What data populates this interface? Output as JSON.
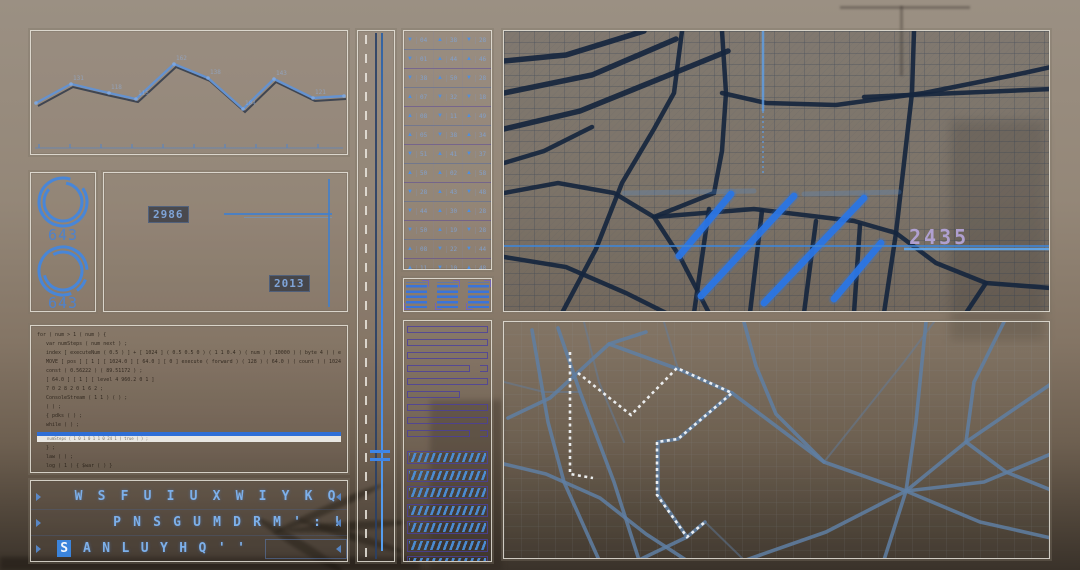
{
  "colors": {
    "accent": "#3b84dc",
    "chart_line": "#6592cf",
    "ring": "#4886d8",
    "indigo": "#4a3f9f",
    "navy": "#16263e",
    "slate": "#5f7fa3",
    "lavender": "#b3a3d6",
    "route_white": "#f2f5f8"
  },
  "line_chart": {
    "points": [
      [
        5,
        72
      ],
      [
        40,
        53
      ],
      [
        78,
        62
      ],
      [
        105,
        68
      ],
      [
        143,
        33
      ],
      [
        177,
        47
      ],
      [
        212,
        78
      ],
      [
        243,
        48
      ],
      [
        282,
        67
      ],
      [
        313,
        65
      ]
    ],
    "labels": [
      "",
      "131",
      "118",
      "115",
      "162",
      "138",
      "104",
      "143",
      "121",
      ""
    ],
    "axis_y": 117,
    "tick_count": 11,
    "tick_start": 8,
    "tick_step": 31
  },
  "gauges": [
    {
      "value": "643"
    },
    {
      "value": "643"
    }
  ],
  "detail": {
    "metric_a": "2986",
    "metric_b": "2013"
  },
  "code_panel": {
    "lines": [
      "for ( num > 1 ( num ) {",
      "var numSteps ( num next ) ;",
      "index [ executeNum ( 0.5 ) ] + [ 1024 ] ( 0.5 0.5 0 ) ( 1 1 0.4 ) ( num ) ( 10000 ) ( byte 4 ) ( executeFlow.up limits.MoveBytes ) ( 1 ) ( 0 ) ( num )",
      "MOVE [ pos ] [ 1 ] [ 1024.0 ] [ 64.0 ] [ 0 ] execute ( forward ) ( 128 ) ( 64.0 ) ( count ) ( 1024 50.0 1 ) ( random ( 100 ) ) ( 1 ) ( 0 )",
      "const ( 0.56222 ) ( 89.51172 ) ;",
      "[ 64.0 ] [ 1 ] [ level 4 960.2 0 1 ]",
      "7 0 2 8 2 0 1 6 2 ;",
      "ConsoleStream ( 1 1 ) ( ) ;",
      "( ) ;",
      "{ pdks ( ) ;",
      "while ( ) ;"
    ],
    "highlight": "numSteps ( 1 0 1 0 1 1 0 24 1 ) true ( ) ;",
    "post_lines": [
      "} ;",
      "law ( ) ;",
      "log ( 1 ) { $war ( ) }",
      "// ( framed ) abject task"
    ]
  },
  "keyboard": {
    "rows": [
      [
        "W",
        "S",
        "F",
        "U",
        "I",
        "U",
        "X",
        "W",
        "I",
        "Y",
        "K",
        "Q"
      ],
      [
        "P",
        "N",
        "S",
        "G",
        "U",
        "M",
        "D",
        "R",
        "M",
        "'",
        ":",
        "!"
      ],
      [
        "S",
        "A",
        "N",
        "L",
        "U",
        "Y",
        "H",
        "Q",
        "'",
        "'"
      ]
    ],
    "active": {
      "row": 2,
      "index": 0
    }
  },
  "icon_grid": {
    "rows": [
      [
        {
          "d": "dn",
          "n": "04"
        },
        {
          "d": "up",
          "n": "38"
        },
        {
          "d": "dn",
          "n": "28"
        }
      ],
      [
        {
          "d": "dn",
          "n": "01"
        },
        {
          "d": "up",
          "n": "44"
        },
        {
          "d": "up",
          "n": "46"
        }
      ],
      [
        {
          "d": "dn",
          "n": "38"
        },
        {
          "d": "up",
          "n": "50"
        },
        {
          "d": "dn",
          "n": "28"
        }
      ],
      [
        {
          "d": "up",
          "n": "07"
        },
        {
          "d": "dn",
          "n": "32"
        },
        {
          "d": "dn",
          "n": "18"
        }
      ],
      [
        {
          "d": "up",
          "n": "08"
        },
        {
          "d": "dn",
          "n": "11"
        },
        {
          "d": "up",
          "n": "49"
        }
      ],
      [
        {
          "d": "up",
          "n": "05"
        },
        {
          "d": "dn",
          "n": "38"
        },
        {
          "d": "up",
          "n": "34"
        }
      ],
      [
        {
          "d": "dn",
          "n": "51"
        },
        {
          "d": "up",
          "n": "41"
        },
        {
          "d": "dn",
          "n": "37"
        }
      ],
      [
        {
          "d": "up",
          "n": "50"
        },
        {
          "d": "up",
          "n": "02"
        },
        {
          "d": "up",
          "n": "58"
        }
      ],
      [
        {
          "d": "dn",
          "n": "28"
        },
        {
          "d": "up",
          "n": "43"
        },
        {
          "d": "dn",
          "n": "48"
        }
      ],
      [
        {
          "d": "dn",
          "n": "44"
        },
        {
          "d": "up",
          "n": "30"
        },
        {
          "d": "up",
          "n": "28"
        }
      ],
      [
        {
          "d": "dn",
          "n": "50"
        },
        {
          "d": "up",
          "n": "19"
        },
        {
          "d": "dn",
          "n": "28"
        }
      ],
      [
        {
          "d": "up",
          "n": "08"
        },
        {
          "d": "dn",
          "n": "22"
        },
        {
          "d": "dn",
          "n": "44"
        }
      ],
      [
        {
          "d": "up",
          "n": "11"
        },
        {
          "d": "dn",
          "n": "10"
        },
        {
          "d": "up",
          "n": "48"
        }
      ]
    ]
  },
  "mini_blocks": {
    "count": 3
  },
  "bars": {
    "outline": [
      {
        "w": 100
      },
      {
        "w": 100
      },
      {
        "w": 100
      },
      {
        "w": 78,
        "br": true
      },
      {
        "w": 100
      },
      {
        "w": 66
      },
      {
        "w": 100
      },
      {
        "w": 100
      },
      {
        "w": 78,
        "br": true
      }
    ],
    "hatched": 8
  },
  "map_top": {
    "label": "2435",
    "major_roads": [
      "M0,62 L88,44 L172,8",
      "M0,98 L76,80 L170,42 L224,20",
      "M0,30 L62,24 L140,0",
      "M58,282 L92,218 L118,152 L150,98 L170,62 L178,0",
      "M0,162 L54,152 L110,162 L150,186 L210,162 L218,120 L222,62 L218,0",
      "M218,62 L262,72 L332,74 L420,62 L520,42 L547,36",
      "M150,186 L176,226 L205,282",
      "M150,186 L250,178 L350,190 L392,202",
      "M410,0 L408,62 L400,132 L392,202 L380,282",
      "M392,202 L432,232 L482,252 L547,257",
      "M360,66 L547,58",
      "M0,226 L62,236 L122,262 L162,282",
      "M205,178 L190,282",
      "M258,180 L246,282",
      "M312,190 L300,282",
      "M356,194 L350,282",
      "M482,252 L462,282",
      "M0,132 L40,120 L88,96"
    ],
    "highlights": [
      [
        175,
        225,
        227,
        163
      ],
      [
        197,
        265,
        290,
        165
      ],
      [
        260,
        272,
        360,
        167
      ],
      [
        330,
        268,
        377,
        212
      ]
    ],
    "streaks": [
      [
        120,
        162,
        250,
        160
      ],
      [
        300,
        163,
        395,
        161
      ]
    ],
    "scan_line_y": 215,
    "beacon_x": 259
  },
  "map_bottom": {
    "roads": [
      "M28,8 L44,100 L60,160 L95,238",
      "M54,6 L76,70 L110,160 L135,238",
      "M4,96 L46,76 L105,22 L142,10",
      "M105,22 L174,47 L228,71",
      "M228,71 L174,117 L154,120 L154,173 L183,215 L201,200",
      "M228,71 L320,140 L402,169",
      "M402,169 L462,120 L547,62",
      "M402,169 L476,200 L547,216",
      "M402,169 L380,238",
      "M402,169 L322,210 L242,238",
      "M402,169 L412,100 L422,0",
      "M500,0 L470,60 L462,120",
      "M547,132 L480,160 L402,169",
      "M0,142 L42,152 L96,176 L142,212 L182,238",
      "M240,0 L252,44 L272,92 L320,140",
      "M135,238 L183,215",
      "M462,120 L502,150 L547,168"
    ],
    "secondary": [
      "M80,0 L95,60 L120,120",
      "M160,0 L174,47",
      "M320,140 L360,90 L400,40 L430,0",
      "M201,200 L240,238",
      "M0,60 L40,70 L76,70"
    ],
    "route_line": "66,30 66,152 89,156",
    "route_poly": "74,51 127,93 173,46 228,71 174,117 153,120 153,173 183,215 201,200"
  }
}
